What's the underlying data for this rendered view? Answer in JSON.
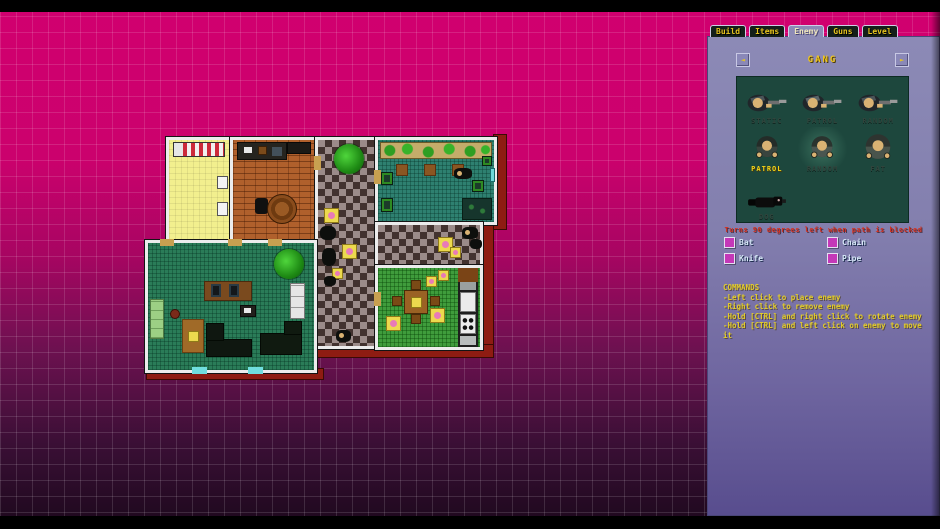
{
  "window": {
    "app_title": "Level Editor"
  },
  "colors": {
    "background_top": "#d1006f",
    "background_bottom": "#1c081c",
    "grid_line": "rgba(255,255,255,0.13)",
    "panel": "#8c8ab6",
    "panel_bottom": "#584d8e",
    "tab_bg": "#141f1a",
    "tab_text": "#e6c31e",
    "enemy_box": "#1d473d",
    "selected_label": "#f2d218",
    "hint_text": "#d23222",
    "checkbox": "#c438b8",
    "weapon_text": "#d6e6f6",
    "commands_text": "#e2cc2a",
    "wall": "#ececec",
    "outer_trim": "#8e1c12"
  },
  "panel": {
    "tabs": [
      {
        "label": "Build",
        "active": false
      },
      {
        "label": "Items",
        "active": false
      },
      {
        "label": "Enemy",
        "active": true
      },
      {
        "label": "Guns",
        "active": false
      },
      {
        "label": "Level",
        "active": false
      }
    ],
    "header": {
      "title": "GANG",
      "left_arrow": "◄",
      "right_arrow": "►"
    },
    "enemy_types": [
      {
        "label": "STATIC",
        "sprite": "gunman",
        "selected": false
      },
      {
        "label": "PATROL",
        "sprite": "gunman",
        "selected": false
      },
      {
        "label": "RANDOM",
        "sprite": "gunman",
        "selected": false
      },
      {
        "label": "PATROL",
        "sprite": "melee",
        "selected": true
      },
      {
        "label": "RANDOM",
        "sprite": "melee",
        "selected": false
      },
      {
        "label": "FAT",
        "sprite": "fat",
        "selected": false
      },
      {
        "label": "DOG",
        "sprite": "dog",
        "selected": false
      }
    ],
    "hint": "Turns 90 degrees left when path is blocked",
    "weapons": [
      {
        "label": "Bat",
        "checked": false
      },
      {
        "label": "Chain",
        "checked": false
      },
      {
        "label": "Knife",
        "checked": false
      },
      {
        "label": "Pipe",
        "checked": false
      }
    ],
    "commands": {
      "title": "COMMANDS",
      "lines": [
        "-Left click to place enemy",
        "-Right click to remove enemy",
        "-Hold [CTRL] and right click to rotate enemy",
        "-Hold [CTRL] and left click on enemy to move it"
      ]
    }
  }
}
